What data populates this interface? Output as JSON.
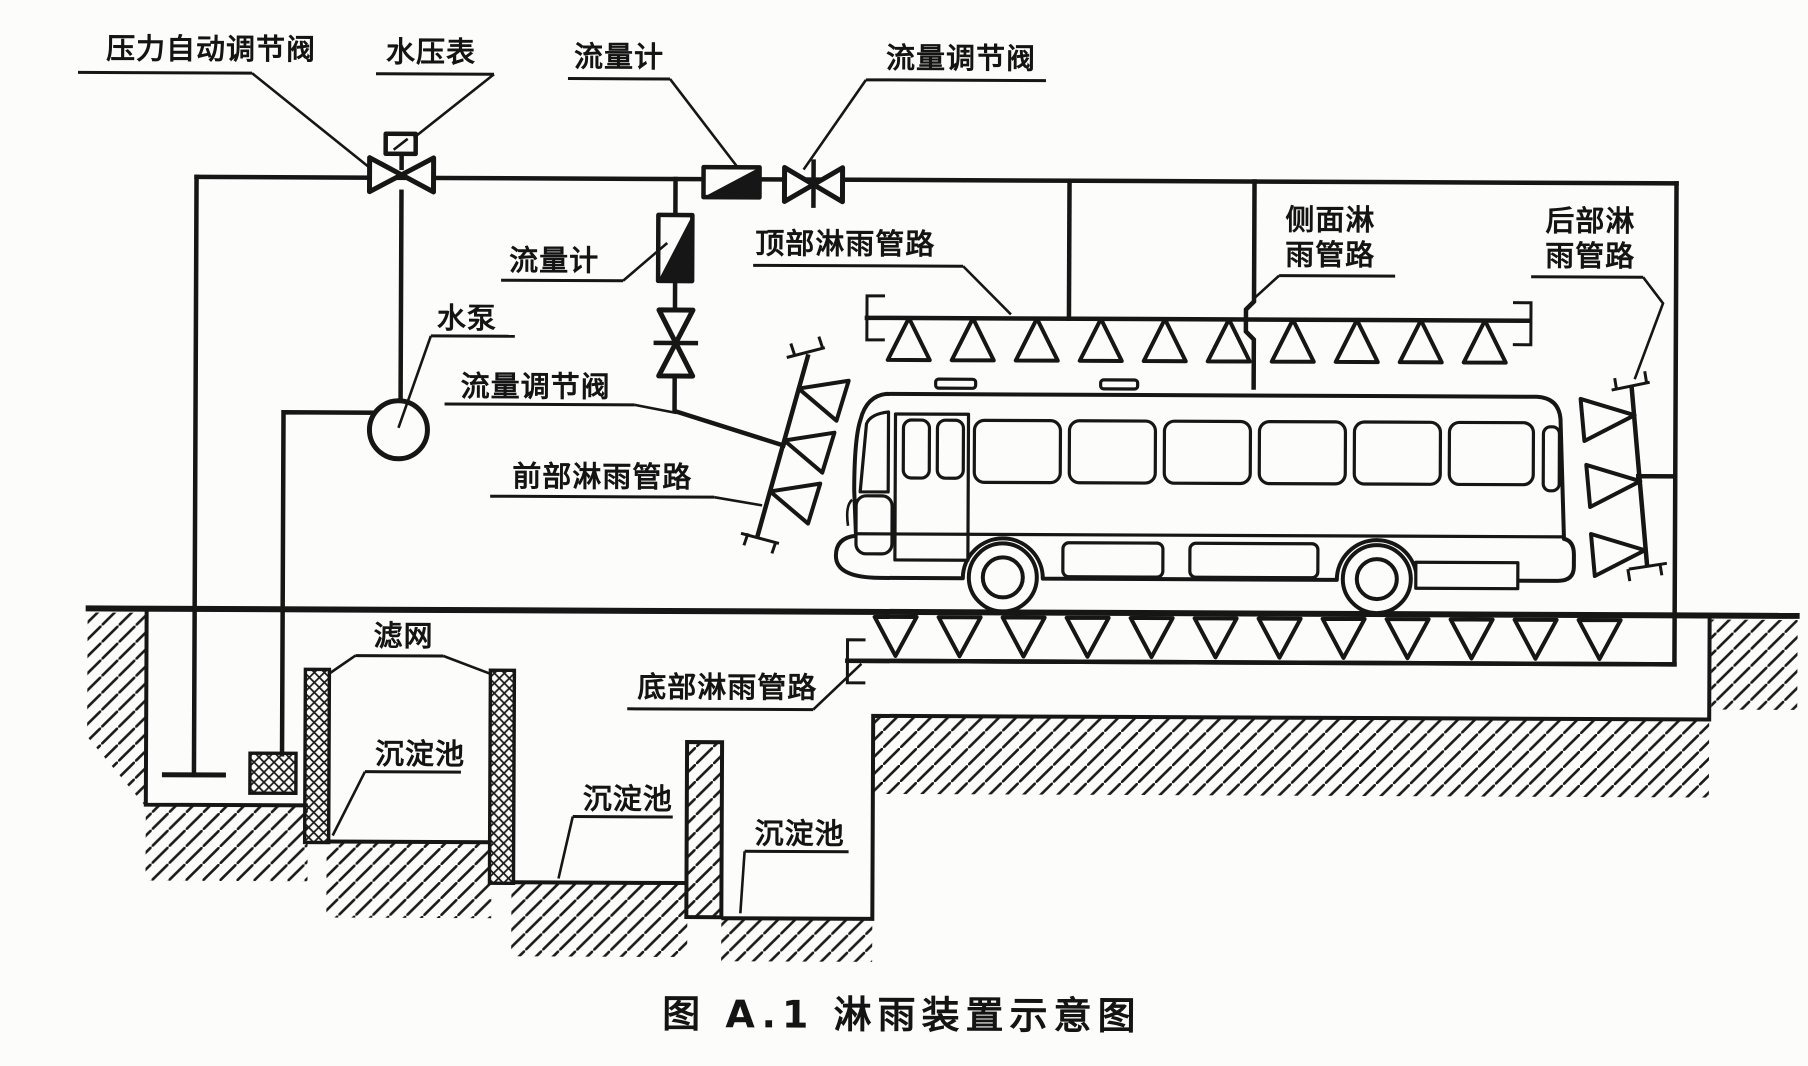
{
  "figure": {
    "caption": "图 A.1  淋雨装置示意图"
  },
  "labels": {
    "pressure_auto_valve": "压力自动调节阀",
    "water_pressure_gauge": "水压表",
    "flow_meter_main": "流量计",
    "flow_valve_main": "流量调节阀",
    "flow_meter_branch": "流量计",
    "water_pump": "水泵",
    "flow_valve_branch": "流量调节阀",
    "front_spray_pipe": "前部淋雨管路",
    "top_spray_pipe": "顶部淋雨管路",
    "side_spray_pipe_line1": "侧面淋",
    "side_spray_pipe_line2": "雨管路",
    "rear_spray_pipe_line1": "后部淋",
    "rear_spray_pipe_line2": "雨管路",
    "bottom_spray_pipe": "底部淋雨管路",
    "filter_screen": "滤网",
    "settling_tank_1": "沉淀池",
    "settling_tank_2": "沉淀池",
    "settling_tank_3": "沉淀池"
  },
  "colors": {
    "ink": "#161616",
    "paper": "#fcfcfa"
  }
}
